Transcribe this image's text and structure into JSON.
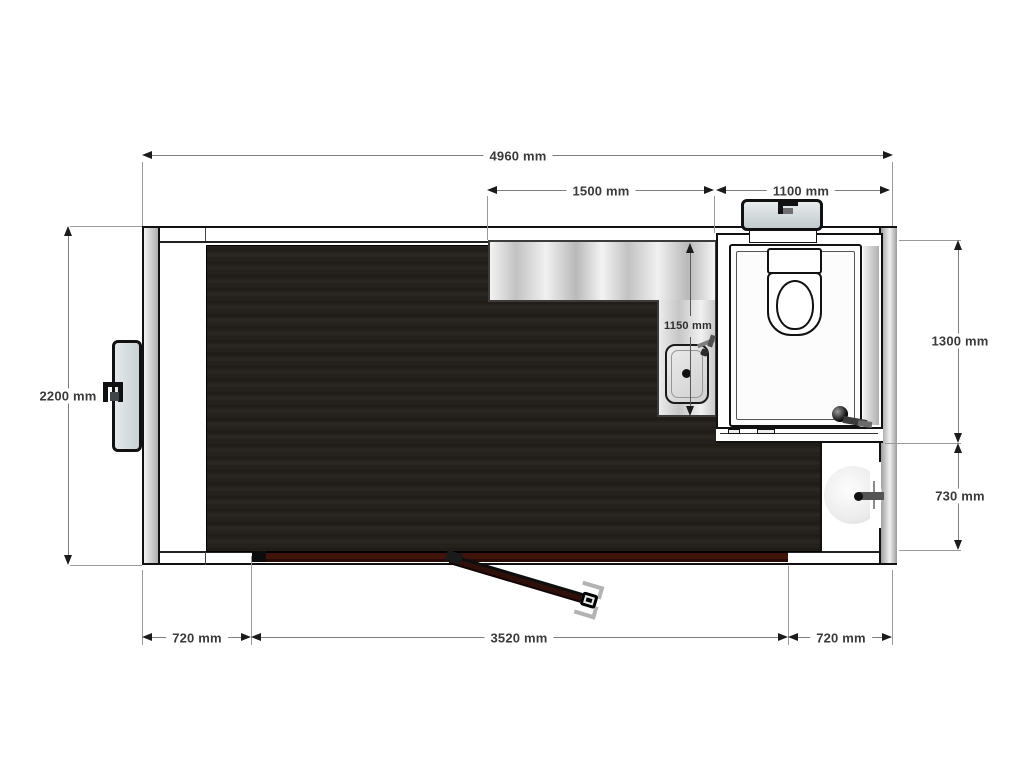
{
  "title": "Mobile unit floor plan",
  "dims": {
    "total_width": "4960 mm",
    "upper_counter": "1500 mm",
    "upper_toilet": "1100 mm",
    "left_height": "2200 mm",
    "right_toilet_depth": "1300 mm",
    "right_basin_depth": "730 mm",
    "counter_run": "1150 mm",
    "bottom_left": "720 mm",
    "bottom_center": "3520 mm",
    "bottom_right": "720 mm"
  },
  "colors": {
    "floor": "#231f1b",
    "door_bar": "#3d120b",
    "wall_gray": "#b5b5b5",
    "hatch_fill": "#dde3e4",
    "dim_line": "#7e7e7e",
    "dim_text": "#3a3a3a",
    "counter_metal": "#d9d9d9"
  },
  "elements": {
    "unit_shell": "unit outer shell",
    "floor": "dark laminate floor",
    "counter": "counter worktop",
    "counter_sink": "counter sink",
    "sink_faucet": "sink faucet",
    "toilet_room": "toilet cubicle",
    "toilet": "toilet",
    "toilet_door_handle": "cubicle door handle",
    "basin_room": "wash basin corner",
    "basin": "round wash basin",
    "basin_faucet": "basin faucet",
    "front_door_bar": "closed entrance door panels",
    "open_door": "open entrance door leaf",
    "left_hatch": "left exterior service hatch",
    "top_hatch": "top exterior service hatch"
  }
}
